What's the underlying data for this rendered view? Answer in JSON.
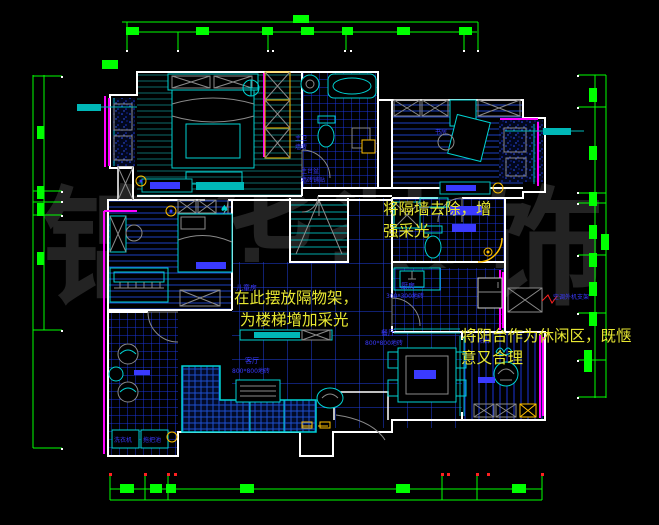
{
  "watermark": {
    "text": "锦华装饰",
    "chars": [
      "锦",
      "华",
      "装",
      "饰"
    ]
  },
  "notes": {
    "remove_wall": {
      "line1": "将隔墙去除，增",
      "line2": "强采光"
    },
    "shelf": {
      "line1": "在此摆放隔物架，",
      "line2": "为楼梯增加采光"
    },
    "balcony": {
      "line1": "将阳台作为休闲区，既惬",
      "line2": "意又合理"
    }
  },
  "rooms": {
    "kid_room": {
      "name": "儿童房"
    },
    "living": {
      "name": "客厅",
      "tile": "800*800地砖"
    },
    "dining": {
      "name": "餐厅",
      "tile": "800*800地砖"
    },
    "kitchen": {
      "name": "厨房",
      "tile": "300*300地砖"
    },
    "master_bath": {
      "name": "主卫",
      "tile": "墙砖"
    },
    "basin": {
      "name": "主台盆",
      "tile": "墙砖铺贴"
    },
    "study": {
      "name": "书房"
    },
    "balcony_right": {
      "name": "阳台"
    },
    "laundry": {
      "washer": "洗衣机",
      "mop": "拖把池"
    }
  },
  "callouts": {
    "ac_bracket": "空调外机支架"
  },
  "symbols": {
    "spade": "♠"
  },
  "colors": {
    "background": "#000000",
    "wall": "#ffffff",
    "fixture": "#00d2d2",
    "tile_grid": "#1a35d8",
    "dimension": "#00ff00",
    "highlight": "#ff00ff",
    "cabinet": "#ffc000",
    "annotation": "#e8e832",
    "room_label": "#3a3aff",
    "watermark": "#232323",
    "alert": "#ff2020"
  }
}
